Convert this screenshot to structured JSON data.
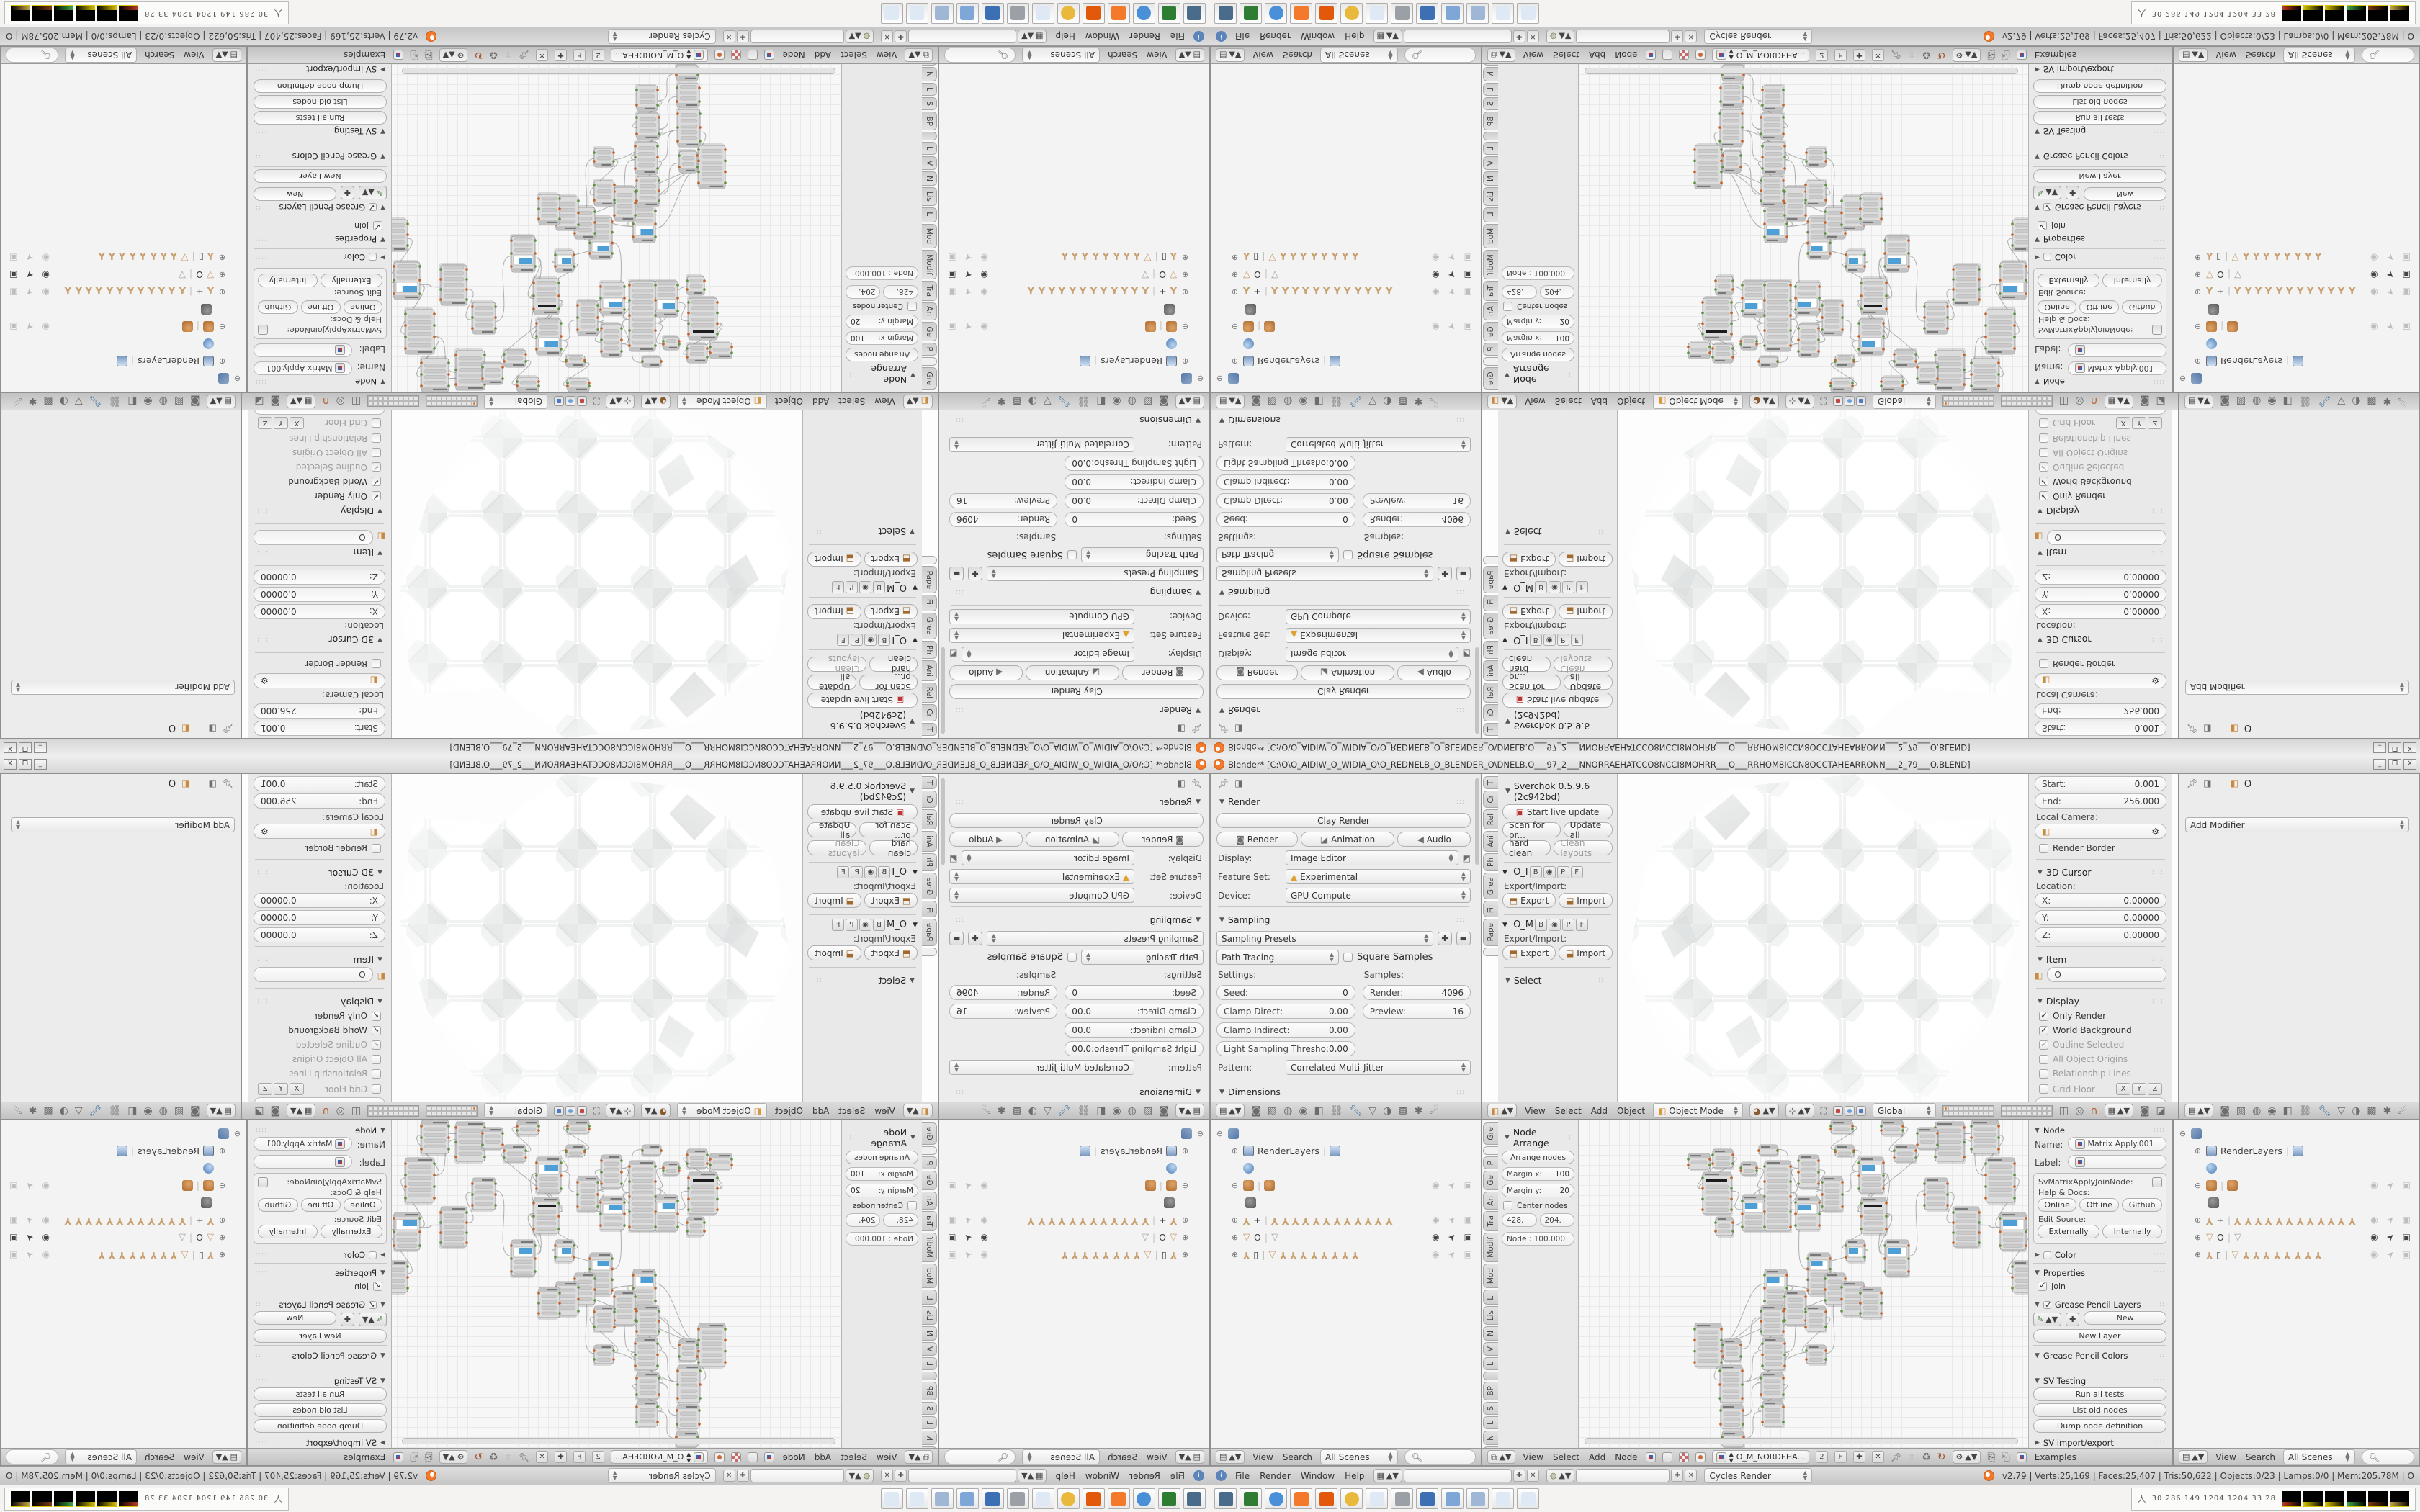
{
  "titlebar": {
    "title": "Blender* [C:\\O\\O_AIDIW_O_WIDIA_O\\O_REDNELB_O_BLENDER_O\\DNELB.O___97_2___NNORRAEHATCCO8NCCI8MOHRR___O___RRHOM8ICCN8OCCTAHEARRONN___2_79___O.BLEND]",
    "minimize": "_",
    "restore": "❐",
    "close": "X"
  },
  "render_props": {
    "panel_render": "Render",
    "clay_render": "Clay Render",
    "render": "Render",
    "animation": "Animation",
    "audio": "Audio",
    "display_label": "Display:",
    "display_value": "Image Editor",
    "feature_label": "Feature Set:",
    "feature_value": "Experimental",
    "device_label": "Device:",
    "device_value": "GPU Compute",
    "panel_sampling": "Sampling",
    "sampling_presets": "Sampling Presets",
    "integrator": "Path Tracing",
    "square_samples": "Square Samples",
    "settings_label": "Settings:",
    "samples_label": "Samples:",
    "seed_label": "Seed:",
    "seed_value": "0",
    "clamp_direct_label": "Clamp Direct:",
    "clamp_direct_value": "0.00",
    "clamp_indirect_label": "Clamp Indirect:",
    "clamp_indirect_value": "0.00",
    "light_sampling_label": "Light Sampling Thresho:",
    "light_sampling_value": "0.00",
    "render_samples_label": "Render:",
    "render_samples_value": "4096",
    "preview_samples_label": "Preview:",
    "preview_samples_value": "16",
    "pattern_label": "Pattern:",
    "pattern_value": "Correlated Multi-Jitter",
    "panel_dimensions": "Dimensions",
    "render_presets": "Render Presets",
    "resolution_label": "Resolution:",
    "res_x_label": "X:",
    "res_x_value": "2048 px",
    "res_y_label": "Y:",
    "res_y_value": "4096 px",
    "res_pct": "100%",
    "frame_range_label": "Frame Range:",
    "start_frame_label": "Start Frame:",
    "start_frame_value": "1",
    "end_frame_label": "End Frame:",
    "end_frame_value": "5824",
    "frame_step_label": "Frame Step:",
    "frame_step_value": "1",
    "aspect_label": "Aspect Ratio:",
    "frame_rate_label": "Frame Rate:"
  },
  "tool_shelf_3d": {
    "tabs": [
      "T",
      "Cr",
      "Rel",
      "Ani",
      "Ph",
      "Grea",
      "Fil",
      "Pape",
      ""
    ],
    "active_tab": 8,
    "panel_title": "Sverchok 0.5.9.6 (2c942bd)",
    "start_live": "Start live update",
    "scan": "Scan for pr...",
    "update_all": "Update all",
    "hard_clean": "hard clean",
    "clean_layouts": "Clean layouts",
    "group1": "O_I",
    "group2": "O_M",
    "mini_b": "B",
    "mini_p": "P",
    "mini_f": "F",
    "export_import": "Export/Import:",
    "export": "Export",
    "import": "Import",
    "panel_select": "Select"
  },
  "view3d": {
    "menus": [
      "View",
      "Select",
      "Add",
      "Object"
    ],
    "mode": "Object Mode",
    "orientation": "Global",
    "np": {
      "start_label": "Start:",
      "start": "0.001",
      "end_label": "End:",
      "end": "256.000",
      "local_camera": "Local Camera:",
      "render_border": "Render Border",
      "cursor_panel": "3D Cursor",
      "location_label": "Location:",
      "x_label": "X:",
      "x": "0.00000",
      "y_label": "Y:",
      "y": "0.00000",
      "z_label": "Z:",
      "z": "0.00000",
      "item_panel": "Item",
      "item_name": "O",
      "display_panel": "Display",
      "only_render": "Only Render",
      "world_bg": "World Background",
      "outline_sel": "Outline Selected",
      "origins": "All Object Origins",
      "rel_lines": "Relationship Lines",
      "grid_floor": "Grid Floor",
      "ax_x": "X",
      "ax_y": "Y",
      "ax_z": "Z",
      "lines_label": "Lines:",
      "lines": "4",
      "scale_label": "Scale:",
      "scale": "1.000",
      "subdiv_label": "Subdivisions:",
      "subdiv": "1",
      "toggle_quad": "Toggle Quad View",
      "shading_panel": "Shading"
    }
  },
  "modifier_props": {
    "object_name": "O",
    "add_modifier": "Add Modifier"
  },
  "outliner": {
    "menus": [
      "View",
      "Search"
    ],
    "scenes": "All Scenes",
    "rows": [
      {
        "type": "scene",
        "label": "",
        "toggles": "none"
      },
      {
        "type": "renderlayers",
        "label": "RenderLayers",
        "toggles": "none"
      },
      {
        "type": "world",
        "label": "",
        "toggles": "none"
      },
      {
        "type": "blob",
        "label": "",
        "toggles": "grey"
      },
      {
        "type": "blobchild",
        "label": "",
        "toggles": "none"
      },
      {
        "type": "armature",
        "label": "+",
        "icons": 12,
        "toggles": "grey"
      },
      {
        "type": "funnel",
        "label": "O",
        "icons": 1,
        "toggles": "dark"
      },
      {
        "type": "armature2",
        "label": "▯",
        "icons": 8,
        "toggles": "grey"
      }
    ]
  },
  "node_editor": {
    "tabs": [
      "Gre",
      "",
      "P",
      "Ge",
      "An",
      "Tra",
      "Modif",
      "Mod",
      "Li",
      "Lis",
      "N",
      "V",
      "L",
      "",
      "BP",
      "S",
      "L",
      "N",
      "Bet",
      "G"
    ],
    "active_tab": 1,
    "arrange": {
      "panel": "Node Arrange",
      "arrange_nodes": "Arrange nodes",
      "margin_x_label": "Margin x:",
      "margin_x": "100",
      "margin_y_label": "Margin y:",
      "margin_y": "20",
      "center_nodes": "Center nodes",
      "val1": "428.",
      "val2": "204.",
      "node_scale": "Node : 100.000"
    },
    "np": {
      "panel": "Node",
      "name_label": "Name:",
      "name": "Matrix Apply.001",
      "label_label": "Label:",
      "label": "",
      "idname": "SvMatrixApplyJoinNode:",
      "help_docs": "Help & Docs:",
      "online": "Online",
      "offline": "Offline",
      "github": "Github",
      "edit_source": "Edit Source:",
      "externally": "Externally",
      "internally": "Internally",
      "color_panel": "Color",
      "properties_panel": "Properties",
      "join": "Join",
      "gp_layers_panel": "Grease Pencil Layers",
      "new": "New",
      "new_layer": "New Layer",
      "gp_colors_panel": "Grease Pencil Colors",
      "sv_testing_panel": "SV Testing",
      "run_all": "Run all tests",
      "list_old": "List old nodes",
      "dump_node": "Dump node definition",
      "sv_ie_panel": "SV import/export",
      "sv_ver_panel": "SV 0.5.9.6 (2c942bd)",
      "start_profiling": "Start profiling"
    },
    "menus": [
      "View",
      "Select",
      "Add",
      "Node"
    ],
    "tree_name": "O_M_NORDEHA...",
    "users": "2",
    "fake": "F",
    "examples": "Examples"
  },
  "infobar": {
    "menus": [
      "File",
      "Render",
      "Window",
      "Help"
    ],
    "engine": "Cycles Render",
    "stats": "v2.79 | Verts:25,169 | Faces:25,407 | Tris:50,622 | Objects:0/23 | Lamps:0/0 | Mem:205.78M | O"
  },
  "taskbar": {
    "apps": [
      {
        "name": "screenshot-tool",
        "color": "#4a6b8a"
      },
      {
        "name": "backup-disk",
        "color": "#2f7d32"
      },
      {
        "name": "chrome",
        "color": "#4a90d9"
      },
      {
        "name": "blender",
        "color": "#f5792a"
      },
      {
        "name": "spiral-app",
        "color": "#e2590b"
      },
      {
        "name": "chrome-2",
        "color": "#e8b93c"
      },
      {
        "name": "notepad",
        "color": "#dfe9f5"
      },
      {
        "name": "volume",
        "color": "#9aa0a6"
      },
      {
        "name": "disk-64",
        "color": "#3d6fb4"
      },
      {
        "name": "image-viewer",
        "color": "#7ea7d8"
      },
      {
        "name": "calculator",
        "color": "#9fb7d4"
      },
      {
        "name": "notepad-2",
        "color": "#dfe9f5"
      },
      {
        "name": "notepad-3",
        "color": "#dfe9f5"
      }
    ],
    "tray_numbers": "30  286  149  1204 1204  33   28",
    "tray_thumb_accents": [
      "#c23b22",
      "#d9c400",
      "#d9c400",
      "#3fae49",
      "#7a3b16",
      "#caa84a"
    ]
  },
  "graph": {
    "accent_blue": "#4d9fd6",
    "nodes": [
      [
        152,
        46,
        30,
        22,
        "g"
      ],
      [
        186,
        40,
        28,
        26,
        "g"
      ],
      [
        172,
        72,
        40,
        58,
        "d"
      ],
      [
        190,
        134,
        24,
        26,
        "g"
      ],
      [
        225,
        58,
        22,
        18,
        "g"
      ],
      [
        227,
        104,
        32,
        50,
        "b"
      ],
      [
        258,
        56,
        36,
        98,
        "t"
      ],
      [
        305,
        48,
        28,
        46,
        "g"
      ],
      [
        301,
        106,
        33,
        46,
        "b"
      ],
      [
        338,
        78,
        28,
        48,
        "g"
      ],
      [
        250,
        34,
        26,
        14,
        "g"
      ],
      [
        356,
        34,
        26,
        16,
        "g"
      ],
      [
        389,
        51,
        34,
        50,
        "b"
      ],
      [
        438,
        34,
        30,
        24,
        "g"
      ],
      [
        392,
        107,
        35,
        50,
        "d"
      ],
      [
        371,
        166,
        26,
        30,
        "b"
      ],
      [
        425,
        166,
        33,
        50,
        "b"
      ],
      [
        318,
        184,
        31,
        58,
        "b"
      ],
      [
        258,
        207,
        31,
        50,
        "b"
      ],
      [
        286,
        237,
        29,
        47,
        "g"
      ],
      [
        342,
        212,
        28,
        44,
        "g"
      ],
      [
        365,
        224,
        31,
        47,
        "g"
      ],
      [
        315,
        258,
        28,
        35,
        "g"
      ],
      [
        391,
        232,
        29,
        42,
        "g"
      ],
      [
        161,
        282,
        37,
        60,
        "t"
      ],
      [
        200,
        304,
        25,
        30,
        "g"
      ],
      [
        196,
        340,
        31,
        52,
        "g"
      ],
      [
        197,
        395,
        31,
        33,
        "g"
      ],
      [
        199,
        432,
        30,
        22,
        "g"
      ],
      [
        253,
        257,
        31,
        42,
        "g"
      ],
      [
        255,
        302,
        31,
        45,
        "g"
      ],
      [
        253,
        350,
        31,
        37,
        "g"
      ],
      [
        255,
        390,
        29,
        35,
        "g"
      ],
      [
        316,
        312,
        27,
        26,
        "g"
      ],
      [
        495,
        2,
        40,
        55,
        "g"
      ],
      [
        545,
        0,
        38,
        46,
        "g"
      ],
      [
        565,
        52,
        40,
        62,
        "t"
      ],
      [
        585,
        128,
        36,
        52,
        "b"
      ],
      [
        602,
        195,
        32,
        44,
        "g"
      ],
      [
        480,
        80,
        32,
        44,
        "g"
      ],
      [
        520,
        120,
        36,
        56,
        "g"
      ],
      [
        470,
        10,
        28,
        30,
        "g"
      ],
      [
        420,
        0,
        30,
        20,
        "g"
      ],
      [
        350,
        0,
        30,
        18,
        "g"
      ]
    ],
    "edges": [
      [
        0,
        2
      ],
      [
        1,
        2
      ],
      [
        2,
        5
      ],
      [
        3,
        6
      ],
      [
        4,
        6
      ],
      [
        5,
        6
      ],
      [
        6,
        7
      ],
      [
        6,
        8
      ],
      [
        7,
        9
      ],
      [
        8,
        9
      ],
      [
        9,
        12
      ],
      [
        10,
        7
      ],
      [
        11,
        12
      ],
      [
        12,
        14
      ],
      [
        13,
        14
      ],
      [
        12,
        16
      ],
      [
        14,
        16
      ],
      [
        15,
        17
      ],
      [
        14,
        15
      ],
      [
        17,
        20
      ],
      [
        18,
        19
      ],
      [
        18,
        21
      ],
      [
        19,
        22
      ],
      [
        20,
        21
      ],
      [
        21,
        23
      ],
      [
        22,
        33
      ],
      [
        24,
        25
      ],
      [
        24,
        26
      ],
      [
        25,
        29
      ],
      [
        26,
        30
      ],
      [
        27,
        31
      ],
      [
        28,
        32
      ],
      [
        29,
        30
      ],
      [
        30,
        31
      ],
      [
        31,
        32
      ],
      [
        33,
        21
      ],
      [
        34,
        36
      ],
      [
        35,
        36
      ],
      [
        36,
        37
      ],
      [
        37,
        38
      ],
      [
        39,
        40
      ],
      [
        40,
        37
      ],
      [
        41,
        35
      ],
      [
        42,
        13
      ],
      [
        43,
        11
      ],
      [
        6,
        17
      ],
      [
        24,
        18
      ],
      [
        24,
        19
      ],
      [
        30,
        22
      ],
      [
        16,
        39
      ],
      [
        24,
        21
      ],
      [
        26,
        33
      ]
    ]
  }
}
